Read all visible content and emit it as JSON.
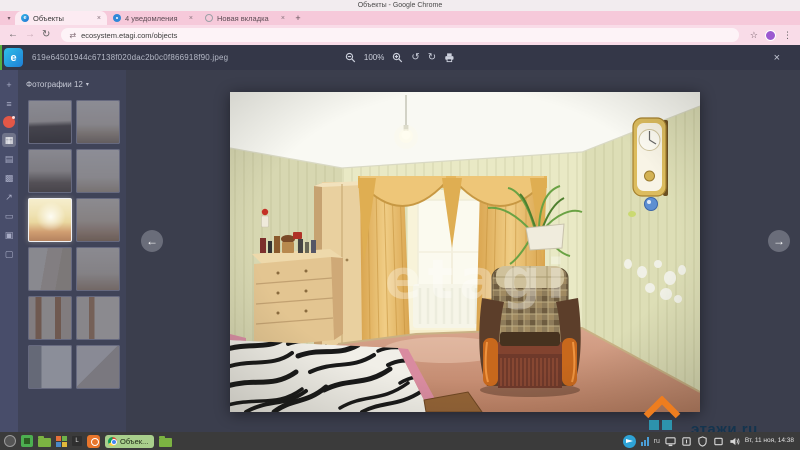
{
  "window": {
    "title": "Объекты - Google Chrome"
  },
  "browser": {
    "tabs": [
      {
        "label": "Объекты"
      },
      {
        "label": "4 уведомления"
      },
      {
        "label": "Новая вкладка"
      }
    ],
    "url": "ecosystem.etagi.com/objects"
  },
  "icons": {
    "tab_search": "▾",
    "close_tab": "×",
    "new_tab": "+",
    "back": "←",
    "forward": "→",
    "reload": "↻",
    "site_info": "⇄",
    "bookmark_star": "☆",
    "menu_dots": "⋮",
    "zoom_out": "−",
    "zoom_in": "+",
    "rotate_left": "↺",
    "rotate_right": "↻",
    "close_viewer": "×",
    "dropdown": "▾",
    "prev": "←",
    "next": "→"
  },
  "viewer": {
    "logo_letter": "e",
    "filename": "619e64501944c67138f020dac2b0c0f866918f90.jpeg",
    "zoom_level": "100%"
  },
  "app_rail": {
    "items": [
      {
        "name": "rail-add-button",
        "glyph": "+"
      },
      {
        "name": "rail-menu-button",
        "glyph": "≡"
      },
      {
        "name": "rail-avatar",
        "glyph": "",
        "avatar": true
      },
      {
        "name": "rail-objects-item",
        "glyph": "▦",
        "selected": true
      },
      {
        "name": "rail-calendar-item",
        "glyph": "▤"
      },
      {
        "name": "rail-apps-item",
        "glyph": "▩"
      },
      {
        "name": "rail-share-item",
        "glyph": "↗"
      },
      {
        "name": "rail-chat-item",
        "glyph": "▭"
      },
      {
        "name": "rail-cards-item",
        "glyph": "▣"
      },
      {
        "name": "rail-docs-item",
        "glyph": "▢"
      }
    ]
  },
  "photos_panel": {
    "label": "Фотографии 12",
    "thumbnails": [
      {
        "variant": 1
      },
      {
        "variant": 2
      },
      {
        "variant": 3
      },
      {
        "variant": 4
      },
      {
        "variant": 5,
        "selected": true
      },
      {
        "variant": 6
      },
      {
        "variant": 7
      },
      {
        "variant": 8
      },
      {
        "variant": 9
      },
      {
        "variant": 10
      },
      {
        "variant": 11
      },
      {
        "variant": 12
      }
    ]
  },
  "photo": {
    "watermark_text": "etagi",
    "brand_watermark": "этажи.ru"
  },
  "taskbar": {
    "active_window": "Объек...",
    "keyboard_layout": "ru",
    "clock": "Вт, 11 ноя, 14:38"
  },
  "colors": {
    "chrome_theme_pink": "#f6c9da",
    "overlay_dark": "#3b3e4d",
    "rail_indigo": "#484d6a",
    "task_pill_green": "#a9cf8c",
    "etagi_orange": "#ee7d1f",
    "etagi_teal": "#2d93ad"
  }
}
